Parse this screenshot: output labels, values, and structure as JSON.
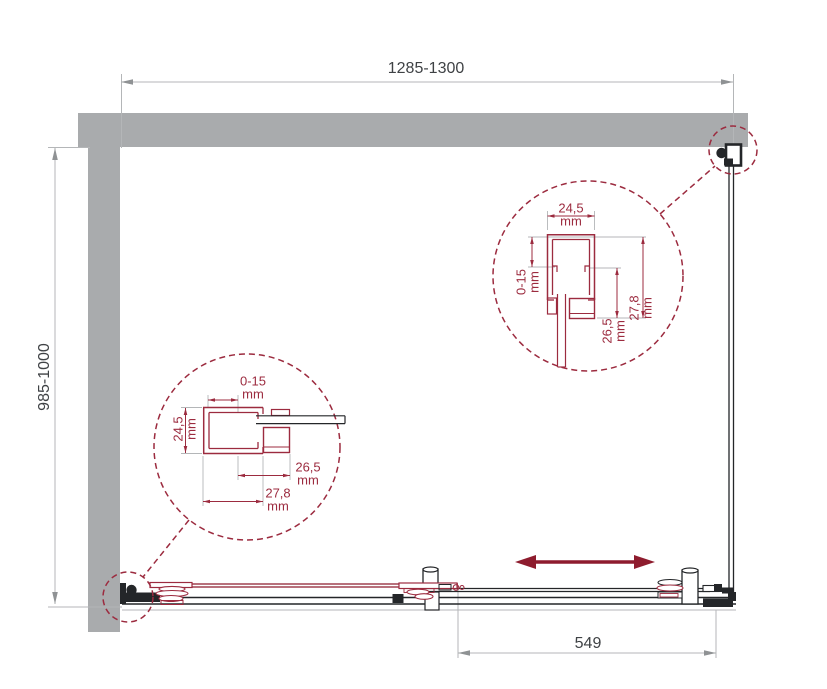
{
  "colors": {
    "wall": "#a9abad",
    "maroon": "#9c2b3f",
    "arrow_red": "#8e1c2e",
    "dim_line": "#b4b6b8",
    "dim_arrow": "#8f9294",
    "dim_text": "#3f4245",
    "dark": "#242629",
    "bg": "#ffffff"
  },
  "dimensions": {
    "width_label": "1285-1300",
    "depth_label": "985-1000",
    "panel_label": "549"
  },
  "detail_left": {
    "top_value": "0-15",
    "top_unit": "mm",
    "left_value": "24,5",
    "left_unit": "mm",
    "right_value": "26,5",
    "right_unit": "mm",
    "bottom_value": "27,8",
    "bottom_unit": "mm"
  },
  "detail_right": {
    "top_value": "24,5",
    "top_unit": "mm",
    "left_value": "0-15",
    "left_unit": "mm",
    "middle_value": "26,5",
    "middle_unit": "mm",
    "right_value": "27,8",
    "right_unit": "mm"
  }
}
